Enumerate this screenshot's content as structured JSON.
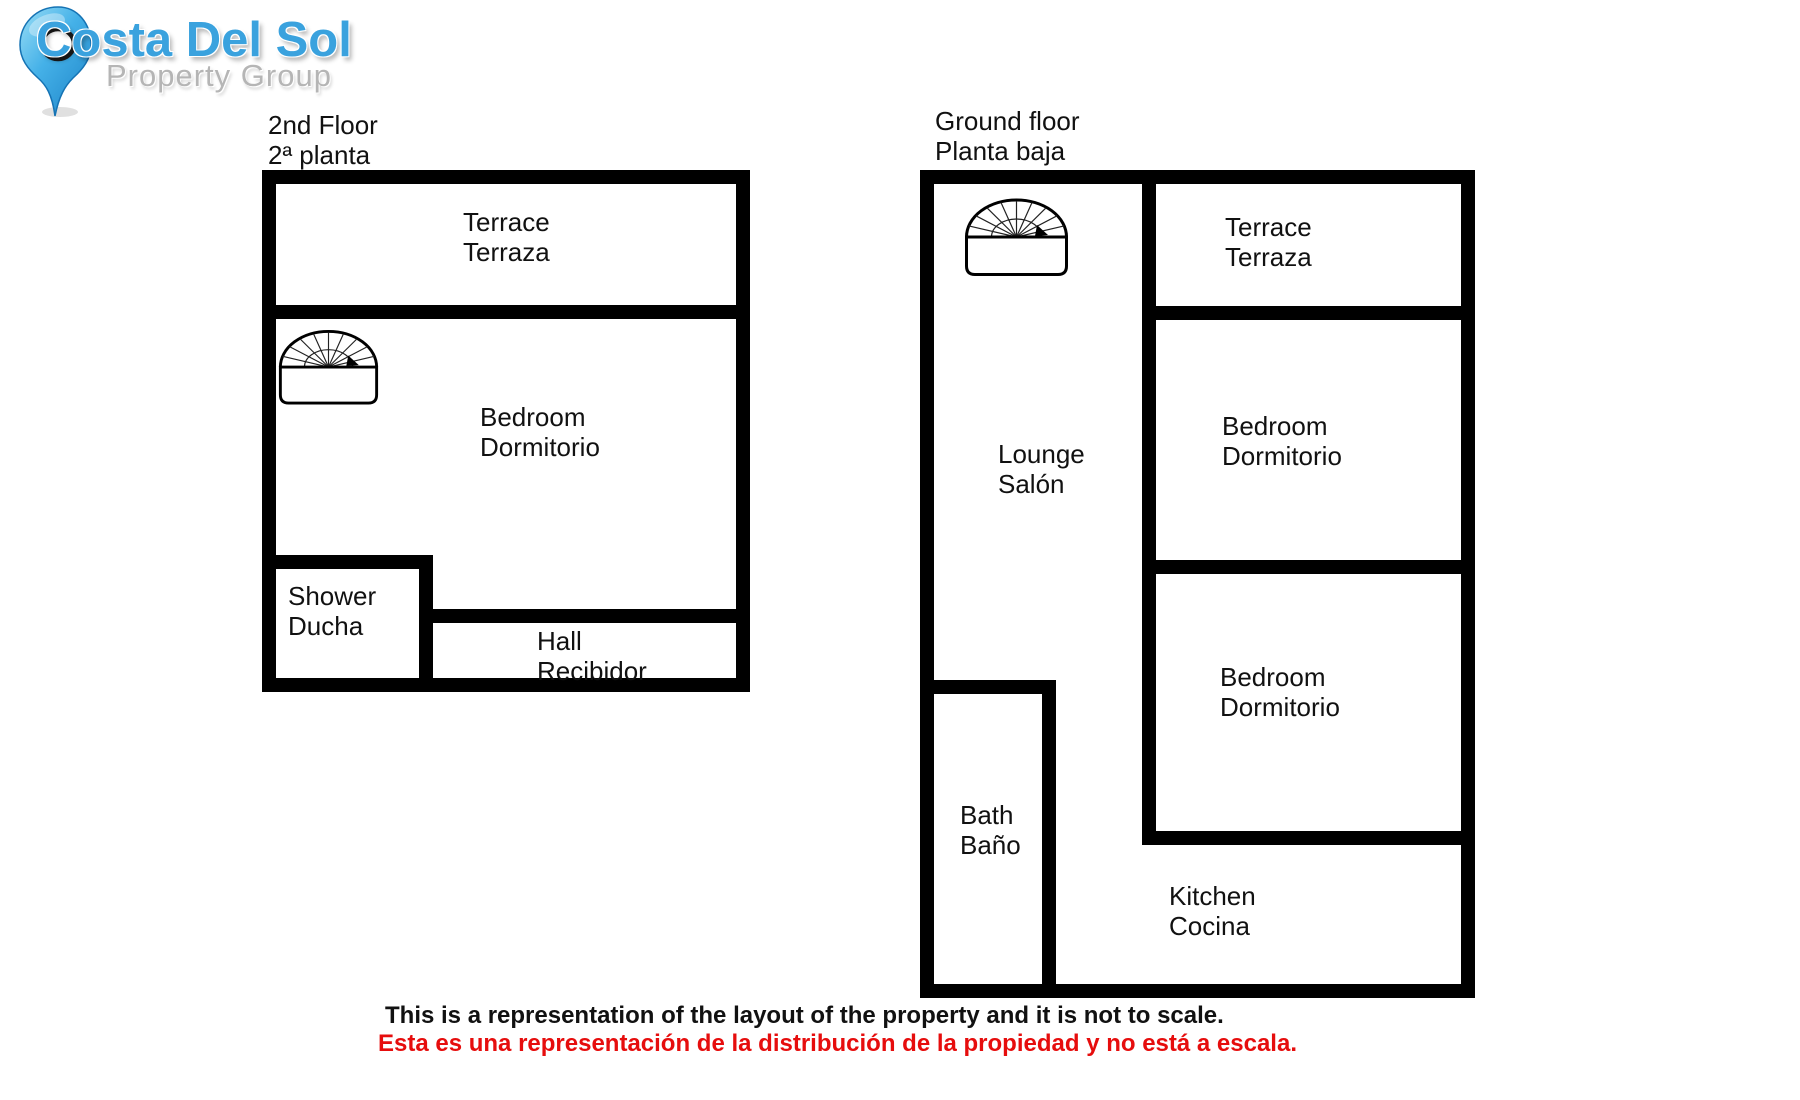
{
  "logo": {
    "brand": "Costa Del Sol",
    "tagline": "Property Group",
    "icon": "map-pin-icon"
  },
  "colors": {
    "brand_blue": "#3aa2de",
    "tagline_gray": "#b5b5b5",
    "wall_black": "#000000",
    "label_text": "#111111",
    "disclaimer_red": "#e60d0d"
  },
  "plans": {
    "second_floor": {
      "title_en": "2nd Floor",
      "title_es": "2ª planta",
      "stairs_icon": "spiral-staircase-icon",
      "rooms": {
        "terrace": {
          "en": "Terrace",
          "es": "Terraza"
        },
        "bedroom": {
          "en": "Bedroom",
          "es": "Dormitorio"
        },
        "shower": {
          "en": "Shower",
          "es": "Ducha"
        },
        "hall": {
          "en": "Hall",
          "es": "Recibidor"
        }
      }
    },
    "ground_floor": {
      "title_en": "Ground floor",
      "title_es": "Planta baja",
      "stairs_icon": "spiral-staircase-icon",
      "rooms": {
        "terrace": {
          "en": "Terrace",
          "es": "Terraza"
        },
        "lounge": {
          "en": "Lounge",
          "es": "Salón"
        },
        "bedroom1": {
          "en": "Bedroom",
          "es": "Dormitorio"
        },
        "bedroom2": {
          "en": "Bedroom",
          "es": "Dormitorio"
        },
        "bath": {
          "en": "Bath",
          "es": "Baño"
        },
        "kitchen": {
          "en": "Kitchen",
          "es": "Cocina"
        }
      }
    }
  },
  "disclaimer": {
    "en": "This is a representation of the layout of the property and it is not to scale.",
    "es": "Esta es una representación de la distribución de la propiedad y no está a escala."
  }
}
